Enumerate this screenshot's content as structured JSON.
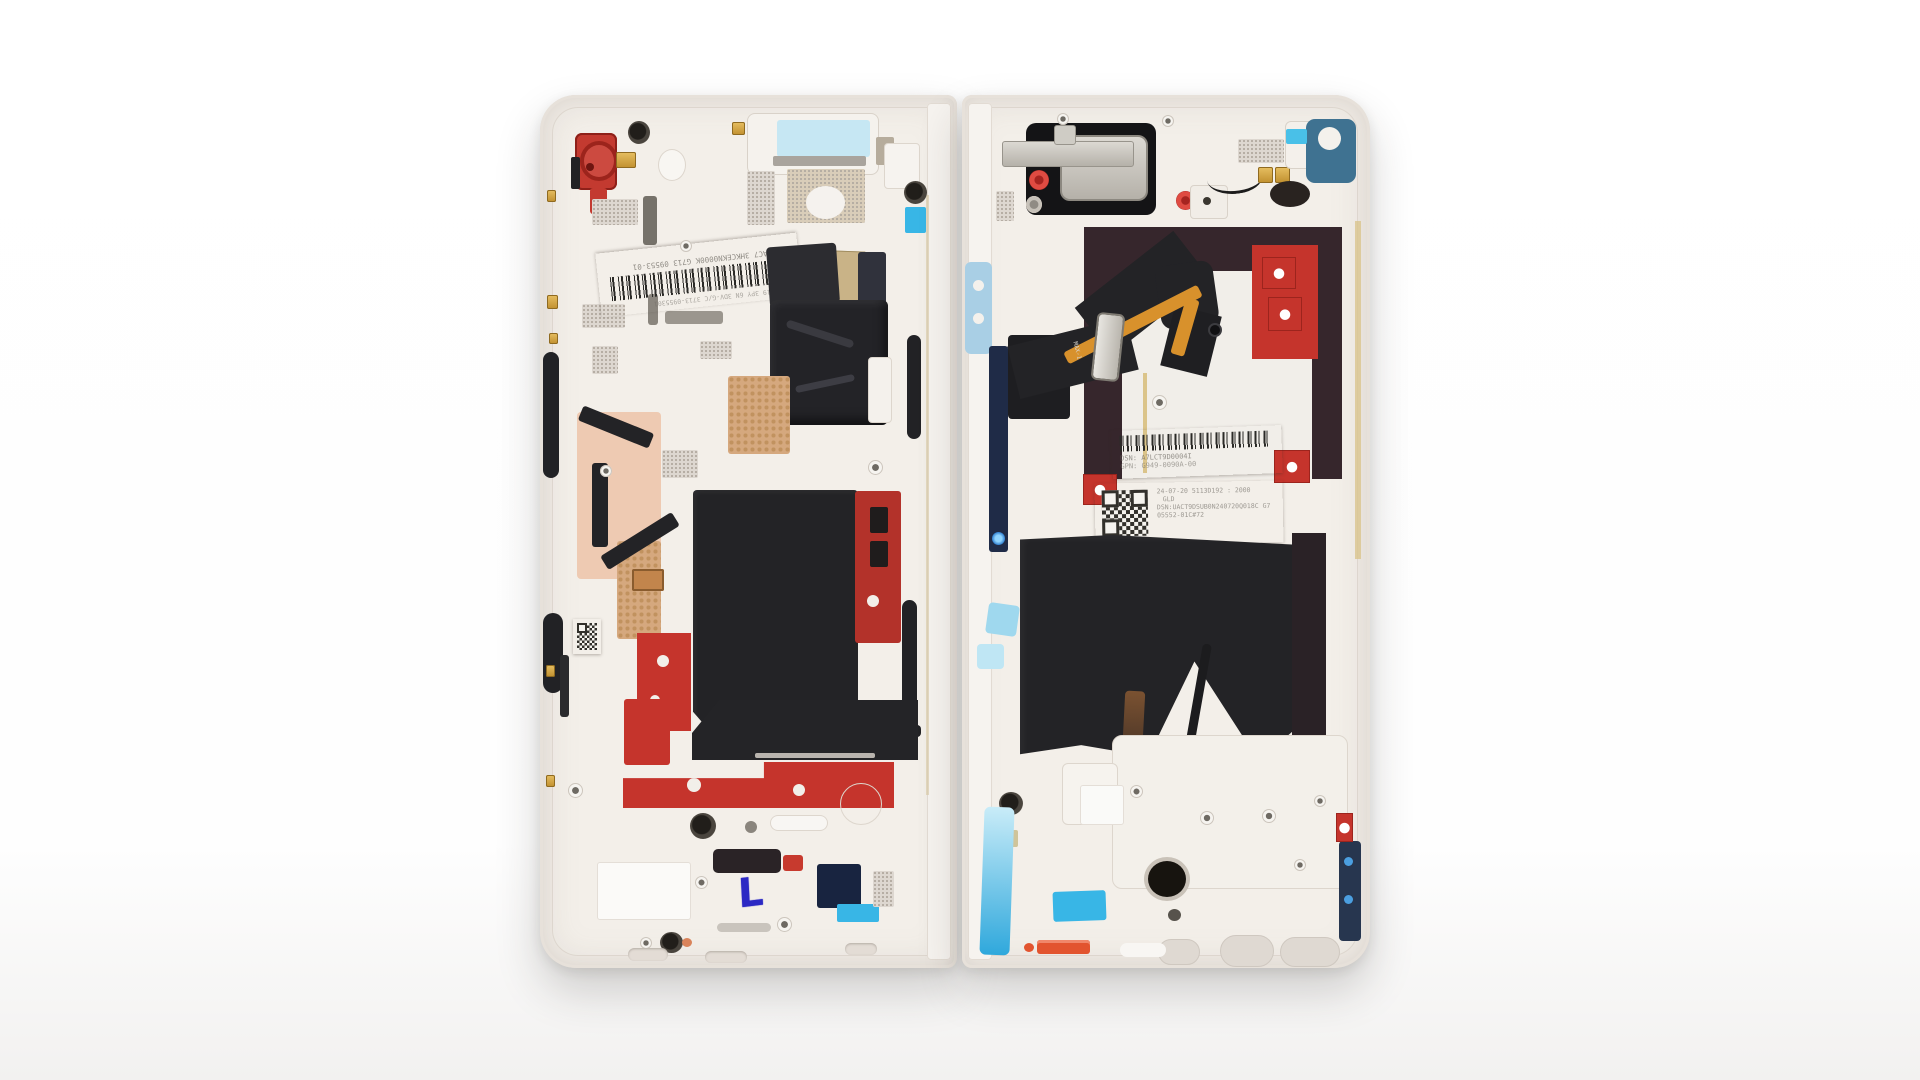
{
  "scene": {
    "description": "Teardown photograph: foldable smartphone opened flat with rear covers removed, exposing internal mid-frames of both halves",
    "background_color": "#ffffff"
  },
  "palette": {
    "frame": "#ece7e1",
    "frame_inner": "#f3efe9",
    "plate_line": "#ddd6ce",
    "accent_red": "#c5342c",
    "maroon": "#36262c",
    "black_part": "#222225",
    "cyan_bright": "#38b6e6",
    "cyan_light": "#a9cfe5",
    "teal": "#3f7291",
    "navy": "#1f2b47",
    "copper": "#d5a87e",
    "salmon": "#eecab2",
    "gold": "#d3a13f",
    "label_white": "#f7f5f1",
    "speckle_bg": "#ddd7d0",
    "speckle_dot": "#b3aba1",
    "ink_blue": "#2b28c4",
    "orange": "#e2542f"
  },
  "left_half": {
    "sticker": {
      "serial_text": "DSN:UAC7 3HKCEKN0000K G713 09553-01",
      "date_text": "24-07-19 3PY 6N 3DV-G/C 3713-0955301"
    },
    "ink_mark": "L"
  },
  "right_half": {
    "speaker": {
      "marking_line1": "1SY",
      "marking_line2": "BOS2P"
    },
    "flex_marking": "MAX-1",
    "sticker_top": {
      "dsn_line": "DSN: A7LCT9D0004I",
      "gpn_line": "GPN: G949-0090A-00"
    },
    "sticker_bottom": {
      "line1": "24-07-20 5113D192 : 2000",
      "line2": "GLD",
      "line3": "DSN:UACT9DSUB0N240720Q018C G7",
      "line4": "05552-01C#72"
    }
  }
}
